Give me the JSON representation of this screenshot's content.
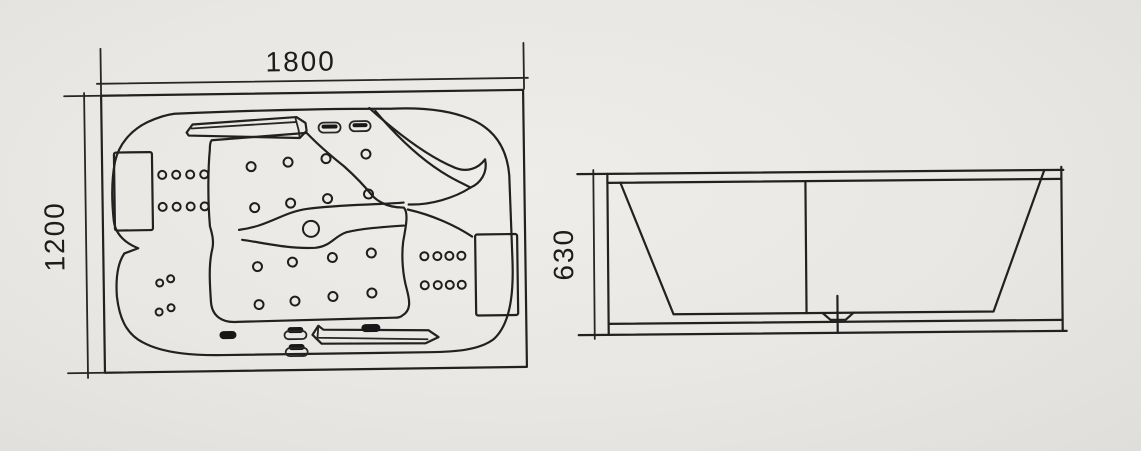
{
  "meta": {
    "description": "Technical line drawing of a two-person whirlpool bathtub: plan (top) view with jets, pillows and headrests, and a side elevation view",
    "background_color": "#e9e7e3",
    "line_color": "#212121"
  },
  "top_view": {
    "width_label": "1800",
    "depth_label": "1200"
  },
  "side_view": {
    "height_label": "630"
  }
}
